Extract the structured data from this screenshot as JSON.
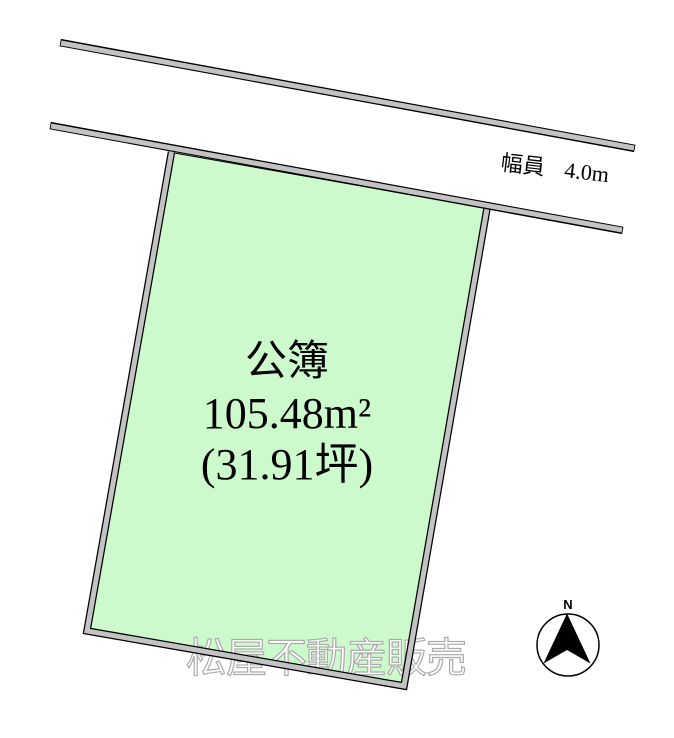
{
  "diagram": {
    "road": {
      "width_label": "幅員",
      "width_value": "4.0m",
      "bar_fill": "#c3c3c3",
      "bar_outline": "#000000"
    },
    "parcel": {
      "fill": "#cdfacd",
      "outline": "#000000",
      "registry_label": "公簿",
      "area_sqm": "105.48m²",
      "area_tsubo": "(31.91坪)"
    },
    "watermark": {
      "text": "松屋不動産販売",
      "color": "#ababab"
    },
    "compass": {
      "north_label": "N",
      "arrow_color": "#000000",
      "circle_stroke": "#000000"
    }
  }
}
